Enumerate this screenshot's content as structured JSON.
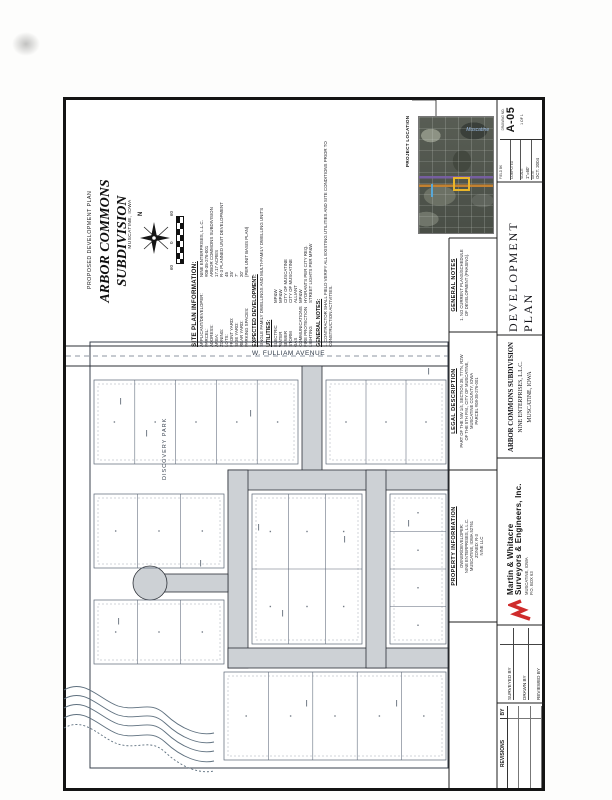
{
  "title_area": {
    "proposed": "PROPOSED DEVELOPMENT PLAN",
    "title_line1": "ARBOR COMMONS",
    "title_line2": "SUBDIVISION",
    "location": "MUSCATINE, IOWA",
    "north_label": "N",
    "scale_labels": [
      "60",
      "0",
      "60"
    ]
  },
  "info_panel": {
    "site_plan": {
      "heading": "SITE PLAN INFORMATION:",
      "rows": [
        {
          "label": "APPLICANT/DEVELOPER:",
          "value": "NINE ENTERPRISES, L.L.C."
        },
        {
          "label": "PARCEL:",
          "value": "#08-35-276-001"
        },
        {
          "label": "ADDRESS:",
          "value": "ARBOR COMMONS SUBDIVISION"
        },
        {
          "label": "AREA:",
          "value": "17.17 ACRES"
        },
        {
          "label": "ZONING:",
          "value": "R-3 PLANNED UNIT DEVELOPMENT"
        },
        {
          "label": "LOTS:",
          "value": "45"
        },
        {
          "label": "FRONT YARD:",
          "value": "25'"
        },
        {
          "label": "SIDE YARD:",
          "value": "7'"
        },
        {
          "label": "REAR YARD:",
          "value": "20'"
        },
        {
          "label": "PARKING SPACES:",
          "value": "(PER UNIT BASIS PLAN)"
        }
      ]
    },
    "expected": {
      "heading": "EXPECTED DEVELOPMENT:",
      "lines": [
        "SINGLE FAMILY DWELLINGS AND MULTI-FAMILY DWELLING UNITS"
      ]
    },
    "utilities": {
      "heading": "UTILITIES:",
      "rows": [
        {
          "label": "ELECTRIC",
          "value": "MP&W"
        },
        {
          "label": "WATER",
          "value": "MP&W"
        },
        {
          "label": "SEWER",
          "value": "CITY OF MUSCATINE"
        },
        {
          "label": "STORM",
          "value": "CITY OF MUSCATINE"
        },
        {
          "label": "GAS",
          "value": "ALLIANT"
        },
        {
          "label": "COMMUNICATIONS",
          "value": "MP&W"
        },
        {
          "label": "FIRE PROTECTION",
          "value": "HYDRANTS PER CITY REQ."
        },
        {
          "label": "LIGHTING",
          "value": "STREET LIGHTS PER MP&W"
        }
      ]
    },
    "general_notes": {
      "heading": "GENERAL NOTES:",
      "lines": [
        "1. CONTRACTOR SHALL FIELD VERIFY ALL EXISTING UTILITIES AND SITE CONDITIONS PRIOR TO",
        "    CONSTRUCTION ACTIVITIES."
      ]
    }
  },
  "plat": {
    "street_label": "W. FULLIAM AVENUE",
    "park_label": "DISCOVERY PARK",
    "road_fill": "#cdd1d5",
    "roads": [
      {
        "x": 302,
        "y": 366,
        "w": 20,
        "h": 112
      },
      {
        "x": 228,
        "y": 470,
        "w": 220,
        "h": 20
      },
      {
        "x": 228,
        "y": 470,
        "w": 20,
        "h": 198
      },
      {
        "x": 228,
        "y": 648,
        "w": 220,
        "h": 20
      },
      {
        "x": 366,
        "y": 470,
        "w": 20,
        "h": 198
      },
      {
        "x": 160,
        "y": 574,
        "w": 68,
        "h": 18
      }
    ],
    "culdesac": {
      "cx": 150,
      "cy": 583,
      "r": 17
    },
    "blocks": [
      {
        "x": 94,
        "y": 380,
        "w": 204,
        "h": 84,
        "cols": 5,
        "rows": 1
      },
      {
        "x": 326,
        "y": 380,
        "w": 120,
        "h": 84,
        "cols": 3,
        "rows": 1
      },
      {
        "x": 252,
        "y": 494,
        "w": 110,
        "h": 150,
        "cols": 3,
        "rows": 2
      },
      {
        "x": 390,
        "y": 494,
        "w": 56,
        "h": 150,
        "cols": 1,
        "rows": 4
      },
      {
        "x": 94,
        "y": 494,
        "w": 130,
        "h": 74,
        "cols": 3,
        "rows": 1
      },
      {
        "x": 94,
        "y": 600,
        "w": 130,
        "h": 64,
        "cols": 3,
        "rows": 1
      },
      {
        "x": 224,
        "y": 672,
        "w": 222,
        "h": 88,
        "cols": 5,
        "rows": 1
      }
    ],
    "boundary": {
      "x": 90,
      "y": 342,
      "w": 358,
      "h": 426
    },
    "street_lines": [
      {
        "x1": 66,
        "y1": 346,
        "x2": 448,
        "y2": 346
      },
      {
        "x1": 66,
        "y1": 366,
        "x2": 448,
        "y2": 366
      }
    ],
    "center_line": {
      "x1": 66,
      "y1": 356,
      "x2": 448,
      "y2": 356
    },
    "creek_paths": [
      "M64,690 C85,678 100,700 118,706 C138,712 150,700 165,714 C182,730 200,736 214,733",
      "M64,699 C85,687 100,709 118,715 C138,721 150,709 165,723 C182,739 200,745 214,742",
      "M64,708 C85,696 100,718 118,724 C138,730 150,718 165,732 C182,748 200,754 214,751",
      "M64,718 C85,706 100,728 118,734 C138,740 150,728 165,742 C182,758 200,764 214,761",
      "M64,728 C85,716 100,738 118,744 C138,750 150,738 165,752 C182,768 200,774 214,771"
    ],
    "specks": [
      {
        "x": 120,
        "y": 398
      },
      {
        "x": 146,
        "y": 430
      },
      {
        "x": 258,
        "y": 524
      },
      {
        "x": 282,
        "y": 610
      },
      {
        "x": 344,
        "y": 536
      },
      {
        "x": 408,
        "y": 520
      },
      {
        "x": 118,
        "y": 618
      },
      {
        "x": 306,
        "y": 700
      },
      {
        "x": 396,
        "y": 700
      },
      {
        "x": 428,
        "y": 368
      },
      {
        "x": 200,
        "y": 560
      },
      {
        "x": 250,
        "y": 410
      }
    ]
  },
  "panel_lines": [
    {
      "x1": 497,
      "y1": 100,
      "x2": 497,
      "y2": 788
    },
    {
      "x1": 449,
      "y1": 238,
      "x2": 449,
      "y2": 788
    },
    {
      "x1": 449,
      "y1": 238,
      "x2": 497,
      "y2": 238
    },
    {
      "x1": 449,
      "y1": 332,
      "x2": 497,
      "y2": 332
    },
    {
      "x1": 449,
      "y1": 470,
      "x2": 497,
      "y2": 470
    },
    {
      "x1": 449,
      "y1": 622,
      "x2": 497,
      "y2": 622
    },
    {
      "x1": 497,
      "y1": 182,
      "x2": 545,
      "y2": 182
    },
    {
      "x1": 497,
      "y1": 335,
      "x2": 545,
      "y2": 335
    },
    {
      "x1": 497,
      "y1": 458,
      "x2": 545,
      "y2": 458
    },
    {
      "x1": 497,
      "y1": 625,
      "x2": 545,
      "y2": 625
    },
    {
      "x1": 497,
      "y1": 703,
      "x2": 545,
      "y2": 703
    }
  ],
  "leader_path": "M412,100 L436,100 L436,116",
  "right_column": {
    "project_location": "PROJECT LOCATION",
    "map_label": "Muscatine",
    "general_notes": {
      "heading": "GENERAL NOTES",
      "lines": [
        "1. NO CURRENT PLANS/SCHEDULE",
        "OF DEVELOPMENT (PHASING)."
      ]
    },
    "legal_description": {
      "heading": "LEGAL DESCRIPTION",
      "lines": [
        "PART OF THE NW 1/4, SECTION 35, T77N, R2W",
        "OF THE 5TH P.M., CITY OF MUSCATINE,",
        "MUSCATINE COUNTY, IOWA",
        "PARCEL #08-35-276-001"
      ]
    },
    "property_information": {
      "heading": "PROPERTY INFORMATION",
      "lines": [
        "OWNER/DEVELOPER:",
        "NINE ENTERPRISES, L.L.C.",
        "MUSCATINE, IOWA 52761",
        "ZONED: R-3",
        "NINE LLC"
      ]
    }
  },
  "title_block": {
    "fields": {
      "left": [
        {
          "label": "FIELD BK",
          "value": ""
        },
        {
          "label": "COMPUTED",
          "value": ""
        },
        {
          "label": "SCALE",
          "value": "1\"=60'"
        },
        {
          "label": "DATE",
          "value": "OCT. 2004"
        }
      ],
      "drawing_no_label": "DRAWING NO.",
      "drawing_no": "A-05",
      "sheet": "1 OF 1"
    },
    "sheet_title": "DEVELOPMENT PLAN",
    "project_lines": [
      "ARBOR COMMONS SUBDIVISION",
      "NINE ENTERPRISES, L.L.C.",
      "MUSCATINE, IOWA"
    ],
    "firm": {
      "name_line1": "Martin & Whitacre",
      "name_line2": "Surveyors & Engineers, Inc.",
      "sub_lines": [
        "MUSCATINE, IOWA",
        "P.O. BOX 63"
      ]
    },
    "signoff": [
      {
        "label": "SURVEYED BY"
      },
      {
        "label": "DRAWN BY"
      },
      {
        "label": "REVIEWED BY"
      }
    ],
    "revisions": {
      "header": "REVISIONS",
      "by": "BY",
      "rows": [
        {},
        {},
        {}
      ]
    }
  },
  "palette": {
    "accent_red": "#cf2b2b",
    "photo_yellow": "#e9b62a",
    "photo_orange": "#c8832f",
    "photo_purple": "#7a5fa8",
    "photo_blue": "#58a8d8"
  }
}
